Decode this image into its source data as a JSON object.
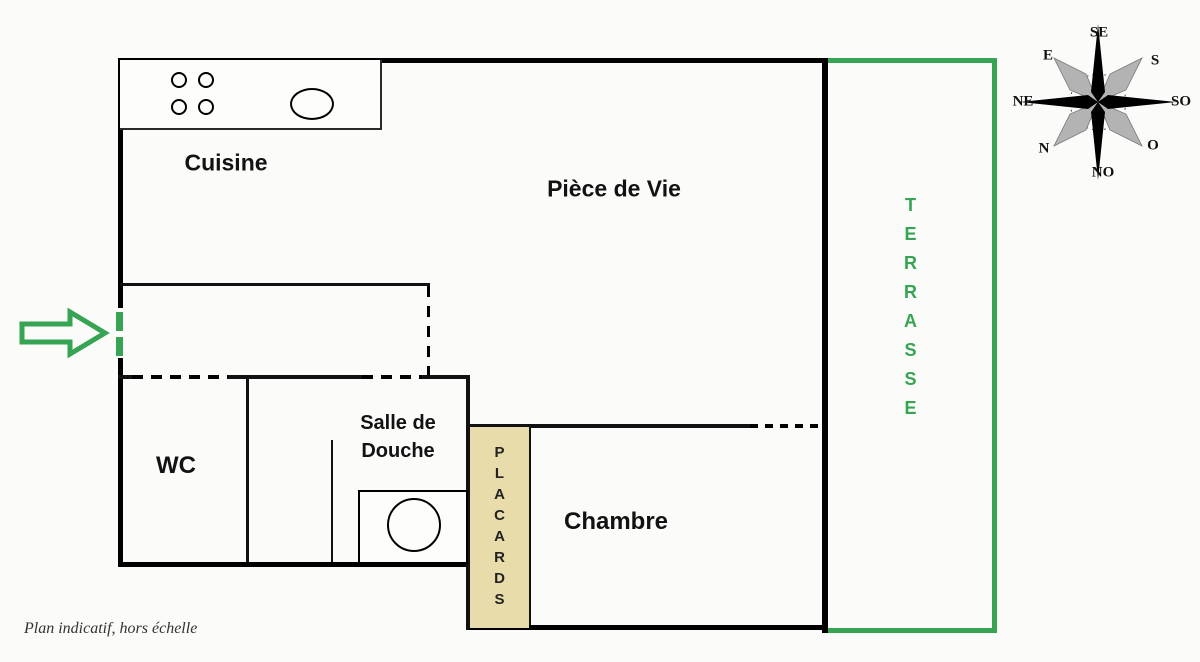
{
  "plan": {
    "rooms": {
      "cuisine": "Cuisine",
      "piece_de_vie": "Pièce de Vie",
      "wc": "WC",
      "salle_de_douche": "Salle de Douche",
      "chambre": "Chambre",
      "placards": "PLACARDS",
      "terrasse": "TERRASSE"
    },
    "compass": {
      "top": "SE",
      "top_right": "S",
      "right": "SO",
      "bottom_right": "O",
      "bottom": "NO",
      "bottom_left": "N",
      "left": "NE",
      "top_left": "E"
    },
    "footnote": "Plan indicatif, hors échelle",
    "colors": {
      "terrace_green": "#36a452",
      "placard_beige": "#e9dcab",
      "wall_black": "#000000"
    }
  }
}
